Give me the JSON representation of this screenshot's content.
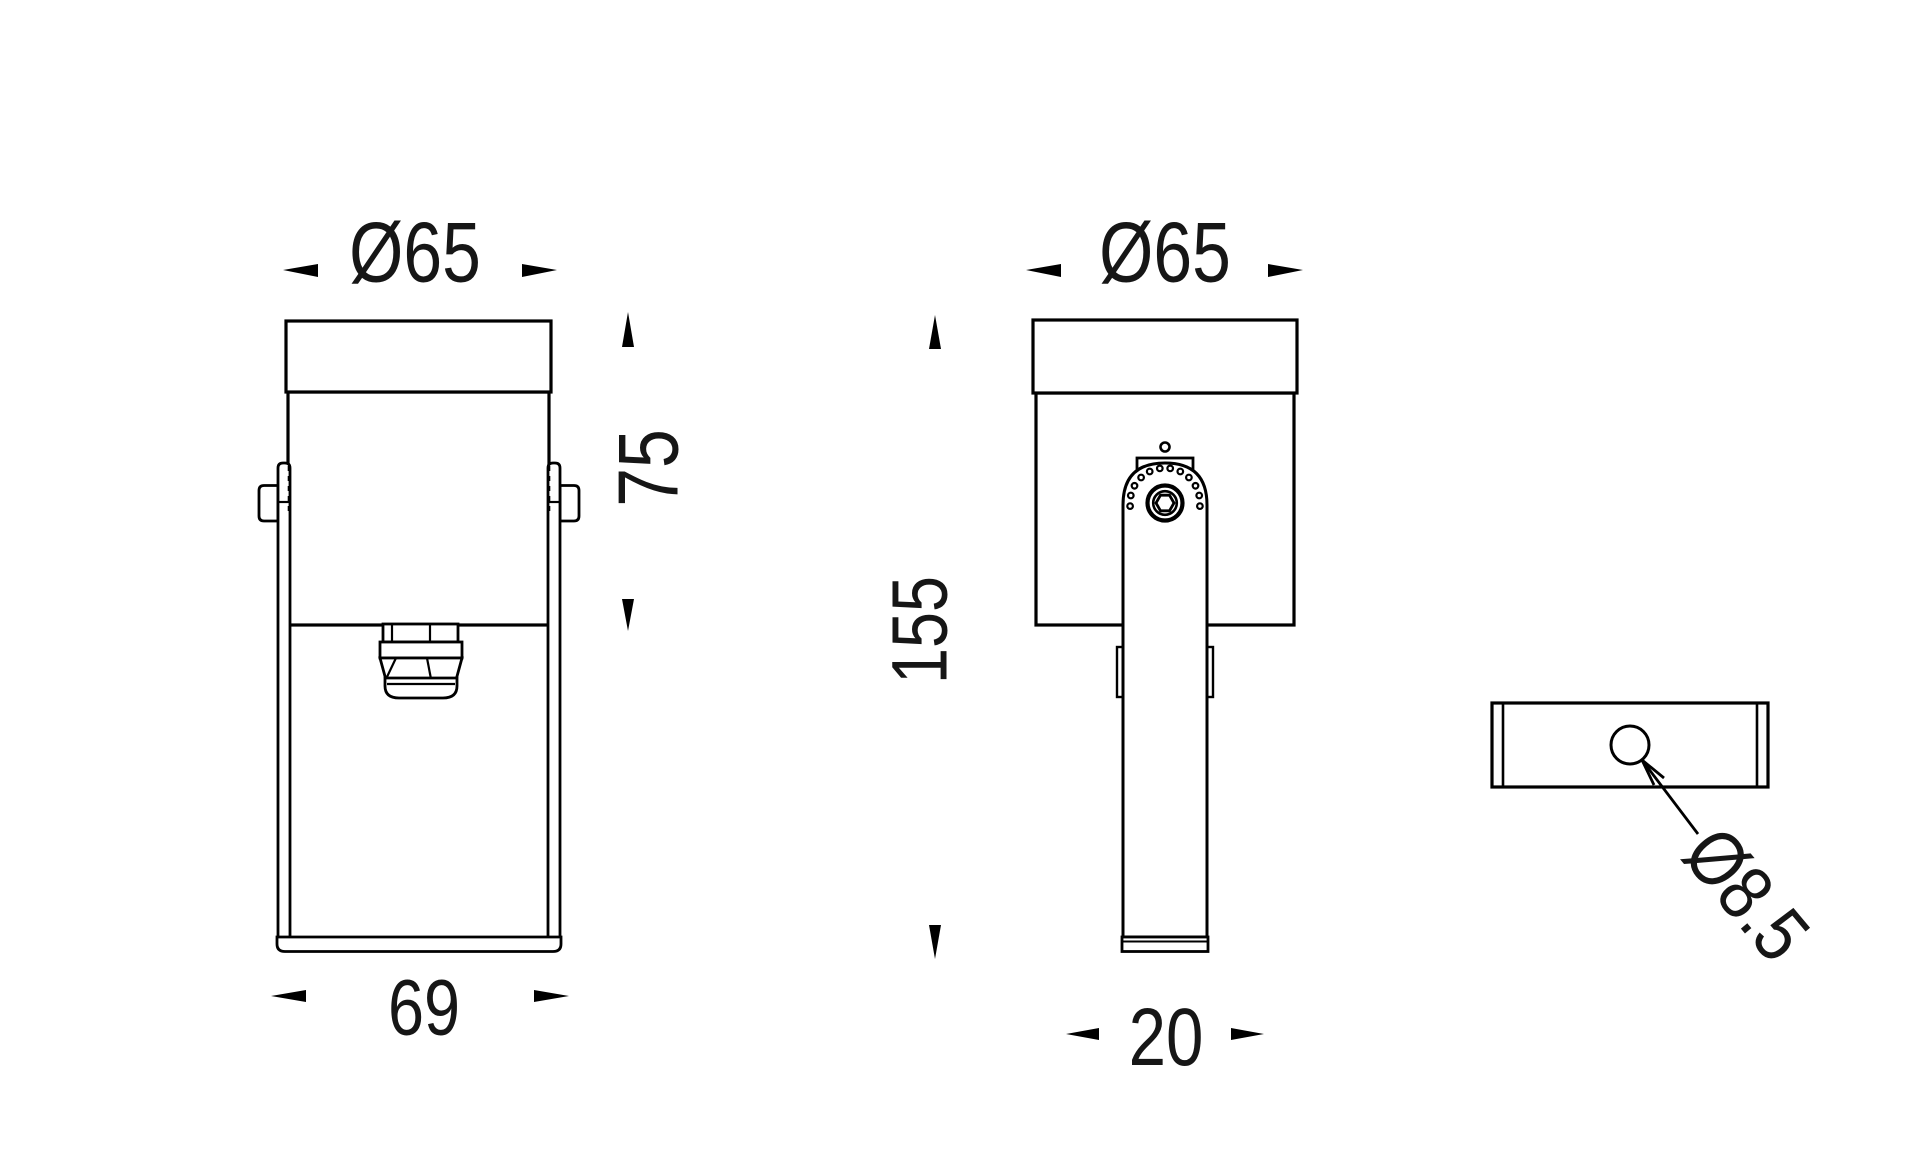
{
  "drawing": {
    "background": "#ffffff",
    "line_color": "#000000",
    "text_color": "#161616",
    "kind": "technical-dimension-drawing"
  },
  "views": {
    "front": {
      "dimensions": {
        "head_diameter": "Ø65",
        "head_height": "75",
        "base_width": "69"
      }
    },
    "side": {
      "dimensions": {
        "head_diameter": "Ø65",
        "overall_height": "155",
        "bracket_depth": "20"
      }
    },
    "base_plate": {
      "dimensions": {
        "mounting_hole_diameter": "Ø8.5"
      }
    }
  }
}
